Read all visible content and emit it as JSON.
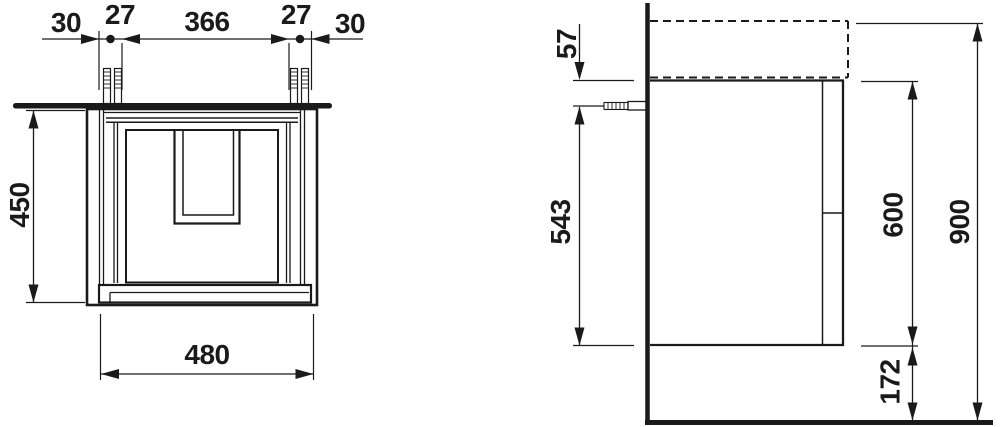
{
  "drawing": {
    "background": "#ffffff",
    "ink": "#1a1a1a",
    "front_view": {
      "top_chain": [
        "30",
        "27",
        "366",
        "27",
        "30"
      ],
      "height": "450",
      "width": "480"
    },
    "side_view": {
      "basin_to_top": "57",
      "fixing_to_bottom": "543",
      "body_height": "600",
      "total_height": "900",
      "bottom_clearance": "172"
    }
  }
}
